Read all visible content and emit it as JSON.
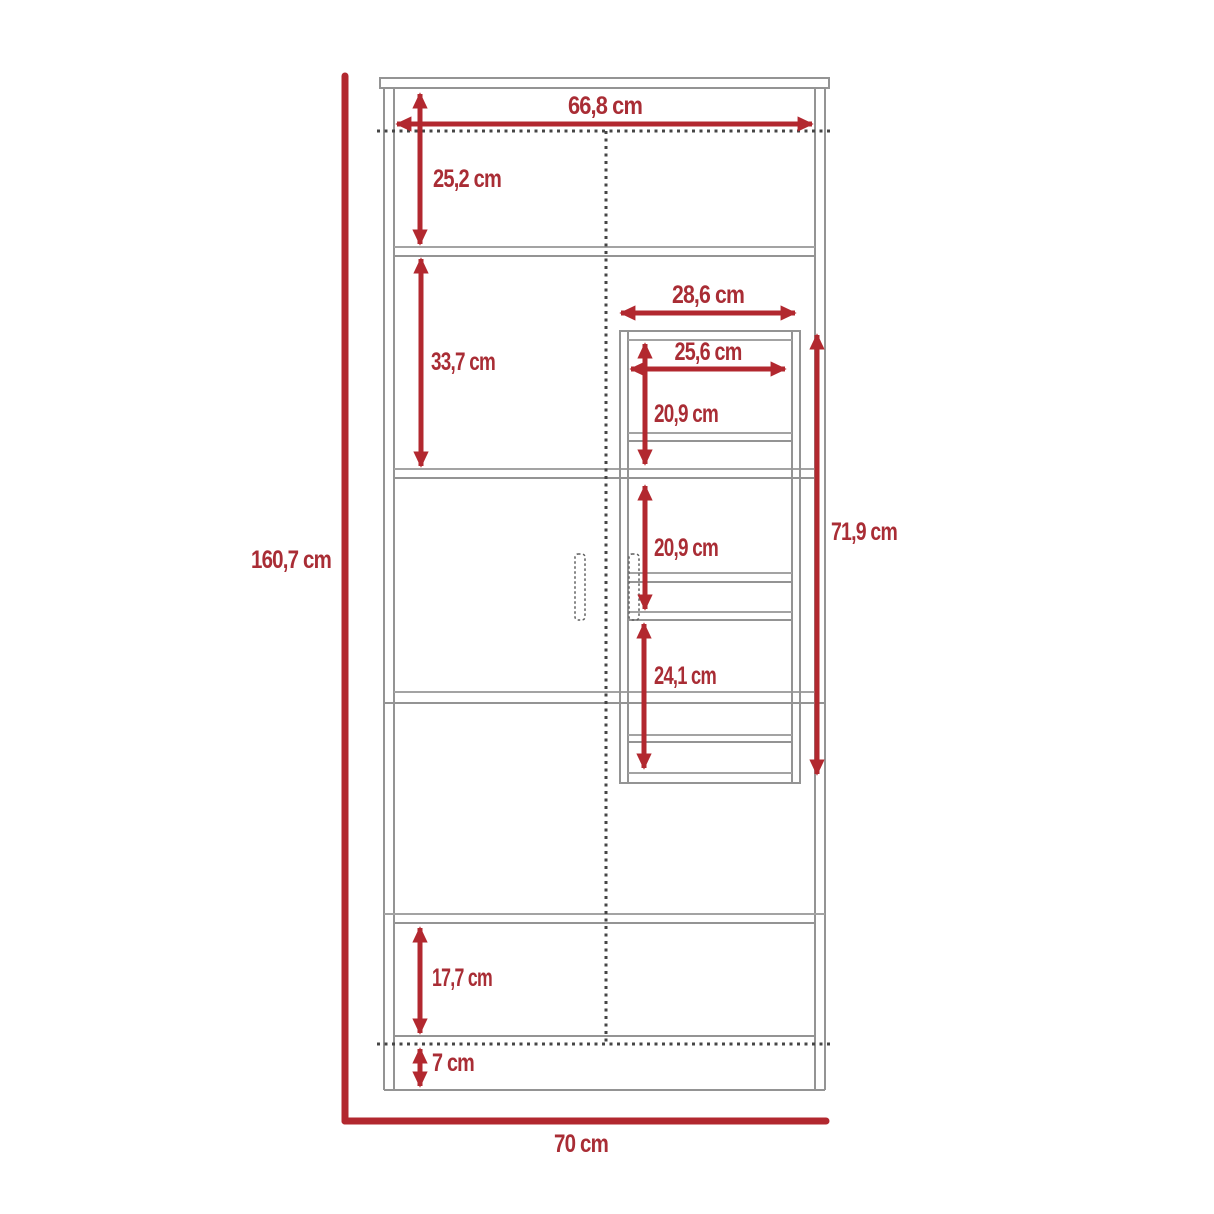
{
  "diagram": {
    "type": "furniture-dimension-diagram",
    "subject": "tall two-door cabinet with interior shelf unit, front elevation",
    "unit": "cm",
    "colors": {
      "dimension_red": "#b2282f",
      "label_red": "#a92d35",
      "outline_gray": "#949494",
      "dotted_dark": "#454545",
      "background": "#ffffff"
    },
    "dimensions": {
      "total_height": {
        "label": "160,7 cm",
        "value_cm": 160.7
      },
      "total_width": {
        "label": "70 cm",
        "value_cm": 70
      },
      "inner_width": {
        "label": "66,8 cm",
        "value_cm": 66.8
      },
      "top_section_height": {
        "label": "25,2 cm",
        "value_cm": 25.2
      },
      "upper_section_height": {
        "label": "33,7 cm",
        "value_cm": 33.7
      },
      "shelf_unit_width": {
        "label": "28,6 cm",
        "value_cm": 28.6
      },
      "shelf_unit_inner_width": {
        "label": "25,6 cm",
        "value_cm": 25.6
      },
      "shelf_unit_top_height": {
        "label": "20,9 cm",
        "value_cm": 20.9
      },
      "shelf_unit_middle_height": {
        "label": "20,9 cm",
        "value_cm": 20.9
      },
      "shelf_unit_bottom_height": {
        "label": "24,1 cm",
        "value_cm": 24.1
      },
      "shelf_unit_total_height": {
        "label": "71,9 cm",
        "value_cm": 71.9
      },
      "drawer_section_height": {
        "label": "17,7 cm",
        "value_cm": 17.7
      },
      "base_height": {
        "label": "7 cm",
        "value_cm": 7
      }
    }
  }
}
